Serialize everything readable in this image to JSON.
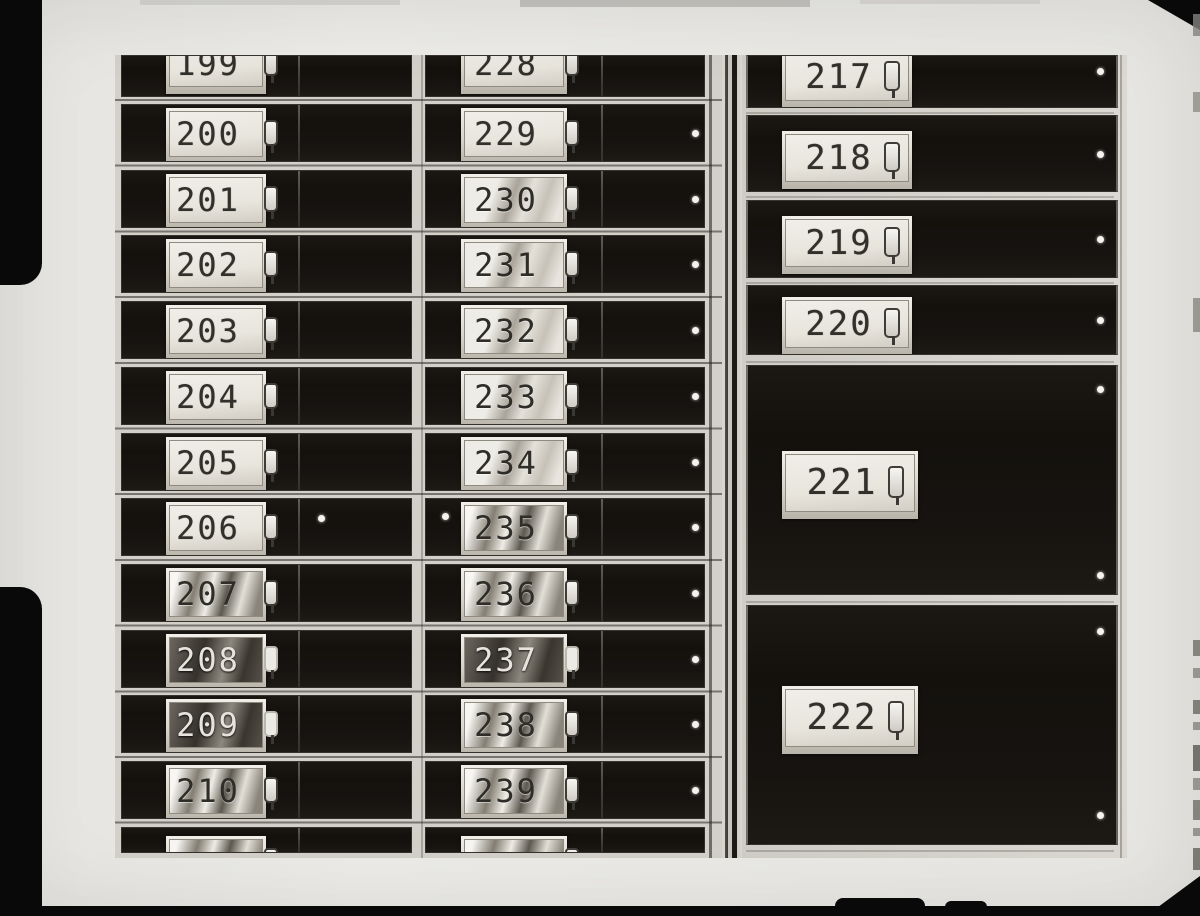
{
  "scene": "black-and-white photograph of a wall of numbered safe deposit boxes",
  "units": {
    "left_column": {
      "rows": [
        {
          "n": "199",
          "finish": "matte",
          "clip": "top"
        },
        {
          "n": "200",
          "finish": "matte"
        },
        {
          "n": "201",
          "finish": "matte"
        },
        {
          "n": "202",
          "finish": "matte"
        },
        {
          "n": "203",
          "finish": "matte"
        },
        {
          "n": "204",
          "finish": "matte"
        },
        {
          "n": "205",
          "finish": "matte"
        },
        {
          "n": "206",
          "finish": "matte",
          "dot": true
        },
        {
          "n": "207",
          "finish": "shiny"
        },
        {
          "n": "208",
          "finish": "dark"
        },
        {
          "n": "209",
          "finish": "dark"
        },
        {
          "n": "210",
          "finish": "shiny"
        },
        {
          "n": "",
          "finish": "shiny",
          "clip": "bottom"
        }
      ]
    },
    "middle_column": {
      "rows": [
        {
          "n": "228",
          "finish": "matte",
          "clip": "top"
        },
        {
          "n": "229",
          "finish": "matte",
          "dot": true
        },
        {
          "n": "230",
          "finish": "streak",
          "dot": true
        },
        {
          "n": "231",
          "finish": "streak",
          "dot": true
        },
        {
          "n": "232",
          "finish": "streak",
          "dot": true
        },
        {
          "n": "233",
          "finish": "streak",
          "dot": true
        },
        {
          "n": "234",
          "finish": "streak",
          "dot": true
        },
        {
          "n": "235",
          "finish": "shiny",
          "dot": true,
          "ldot": true
        },
        {
          "n": "236",
          "finish": "shiny",
          "dot": true
        },
        {
          "n": "237",
          "finish": "dark",
          "dot": true
        },
        {
          "n": "238",
          "finish": "shiny",
          "dot": true
        },
        {
          "n": "239",
          "finish": "shiny",
          "dot": true
        },
        {
          "n": "",
          "finish": "shiny",
          "clip": "bottom"
        }
      ]
    },
    "right_unit": {
      "small_rows": [
        {
          "n": "217",
          "finish": "matte",
          "clip": "top",
          "dot": true
        },
        {
          "n": "218",
          "finish": "matte",
          "dot": true
        },
        {
          "n": "219",
          "finish": "matte",
          "dot": true
        },
        {
          "n": "220",
          "finish": "matte",
          "dot": true
        }
      ],
      "large_boxes": [
        {
          "n": "221",
          "finish": "matte",
          "dots": 2
        },
        {
          "n": "222",
          "finish": "matte",
          "dots": 2
        }
      ]
    }
  },
  "colors": {
    "paper": "#e9e8e5",
    "film_border": "#0a0a0a",
    "box_face": "#17140f",
    "frame_rail": "#d2d0c9",
    "number_plate": "#eae7e0",
    "digit": "#32302b"
  }
}
